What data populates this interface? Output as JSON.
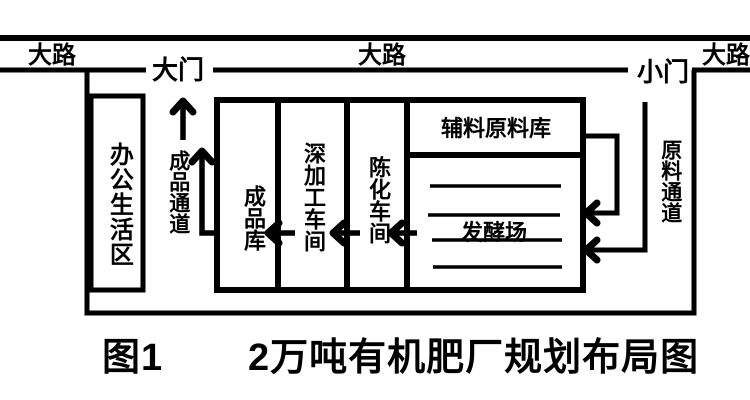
{
  "diagram": {
    "roads": {
      "left": "大路",
      "center": "大路",
      "right": "大路"
    },
    "gates": {
      "main_gate": "大门",
      "side_gate": "小门"
    },
    "zones": {
      "office_living_area": "办公生活区",
      "finished_product_channel": "成品通道",
      "finished_product_warehouse": "成品库",
      "deep_processing_workshop": "深加工车间",
      "aging_workshop": "陈化车间",
      "auxiliary_material_warehouse": "辅料原料库",
      "fermentation_yard": "发酵场",
      "raw_material_channel": "原料通道"
    },
    "caption": {
      "figure_label": "图1",
      "title": "2万吨有机肥厂规划布局图"
    },
    "colors": {
      "line": "#000000",
      "background": "#ffffff"
    }
  }
}
